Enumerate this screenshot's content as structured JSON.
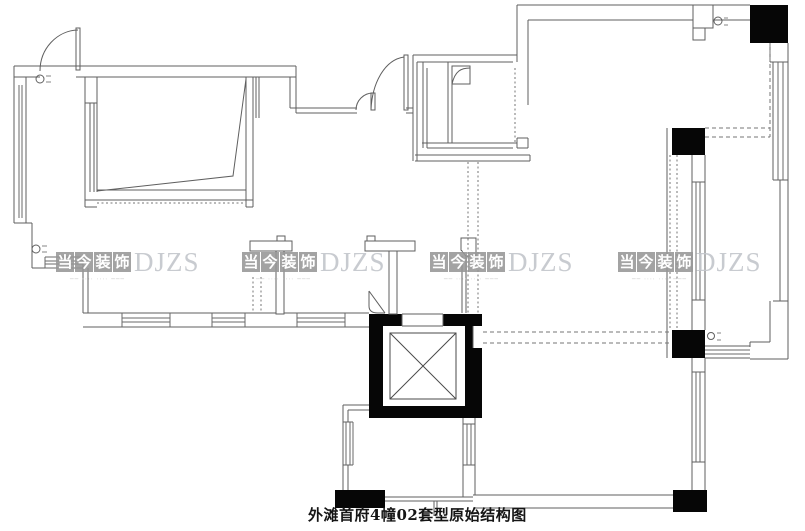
{
  "page": {
    "background": "#ffffff"
  },
  "caption": {
    "title": "外滩首府4幢02套型原始结构图"
  },
  "watermark": {
    "chars": [
      "当",
      "今",
      "装",
      "饰"
    ],
    "latin": "DJZS",
    "tagline": "──  ⋅⋅⋅⋅  ⋅⋅⋅⋅  ───",
    "block_color": "#989898",
    "latin_color": "#c3c6cb"
  },
  "colors": {
    "wall_line": "#5f5f5f",
    "column_fill": "#060606",
    "dashed_line": "#7a7a7a",
    "caption_text": "#151515",
    "background": "#ffffff"
  },
  "symbols": {
    "elevator": "elevator-shaft-x",
    "door": "door-swing-arc",
    "window": "multi-line-window",
    "column": "solid-black-column",
    "riser": "pipe-riser-circle"
  }
}
